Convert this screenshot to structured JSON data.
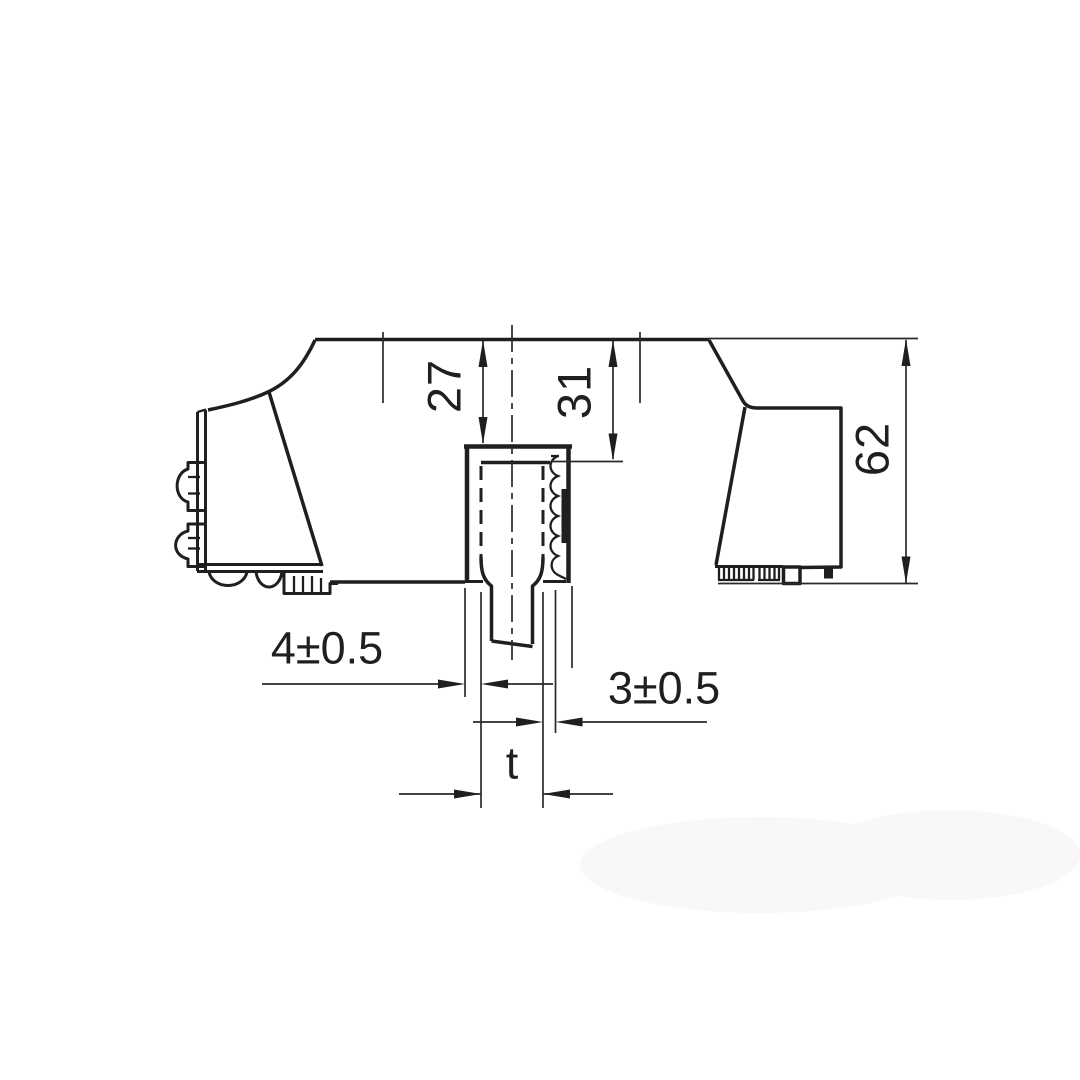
{
  "page": {
    "background": "#ffffff"
  },
  "drawing": {
    "type": "engineering-dimension-drawing",
    "view": "side-profile-with-din-rail-slot",
    "line_color": "#1f1f1f",
    "thin_line_color": "#2a2a2a",
    "labels": {
      "dim_27": "27",
      "dim_31": "31",
      "dim_62": "62",
      "dim_4": "4±0.5",
      "dim_3": "3±0.5",
      "dim_t": "t"
    }
  }
}
